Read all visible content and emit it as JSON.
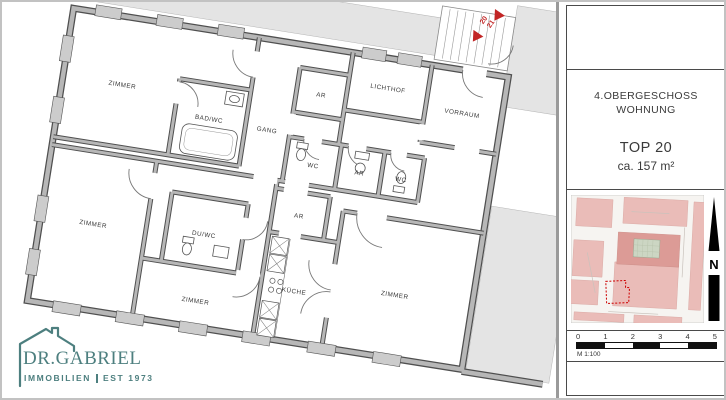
{
  "plan": {
    "rooms": [
      {
        "label": "ZIMMER"
      },
      {
        "label": "BAD/WC"
      },
      {
        "label": "GANG"
      },
      {
        "label": "AR"
      },
      {
        "label": "LICHTHOF"
      },
      {
        "label": "VORRAUM"
      },
      {
        "label": "WC"
      },
      {
        "label": "AR"
      },
      {
        "label": "WC"
      },
      {
        "label": "ZIMMER"
      },
      {
        "label": "DU/WC"
      },
      {
        "label": "ZIMMER"
      },
      {
        "label": "AR"
      },
      {
        "label": "KÜCHE"
      },
      {
        "label": "ZIMMER"
      }
    ],
    "annotations": {
      "unit_a": "20",
      "unit_b": "21"
    },
    "colors": {
      "wall_fill": "#b7b7b7",
      "wall_edge": "#4f4f4f",
      "neighbor_fill": "#e4e4e4",
      "accent_red": "#c22525"
    }
  },
  "sidebar": {
    "title_line1": "4.OBERGESCHOSS",
    "title_line2": "WOHNUNG",
    "top_label": "TOP 20",
    "area_label": "ca. 157 m²",
    "north": "N",
    "scale_label": "M 1:100",
    "ticks": [
      "0",
      "1",
      "2",
      "3",
      "4",
      "5"
    ],
    "map_colors": {
      "block_pink": "#eabcb8",
      "block_pink_dark": "#dc9b96",
      "street": "#f6f4f1",
      "courtyard": "#ccd6c3",
      "subject_outline_red": "#cc0000"
    }
  },
  "logo": {
    "brand": "DR.GABRIEL",
    "tagline_left": "IMMOBILIEN",
    "tagline_right": "EST 1973",
    "color": "#4d7f7f"
  }
}
